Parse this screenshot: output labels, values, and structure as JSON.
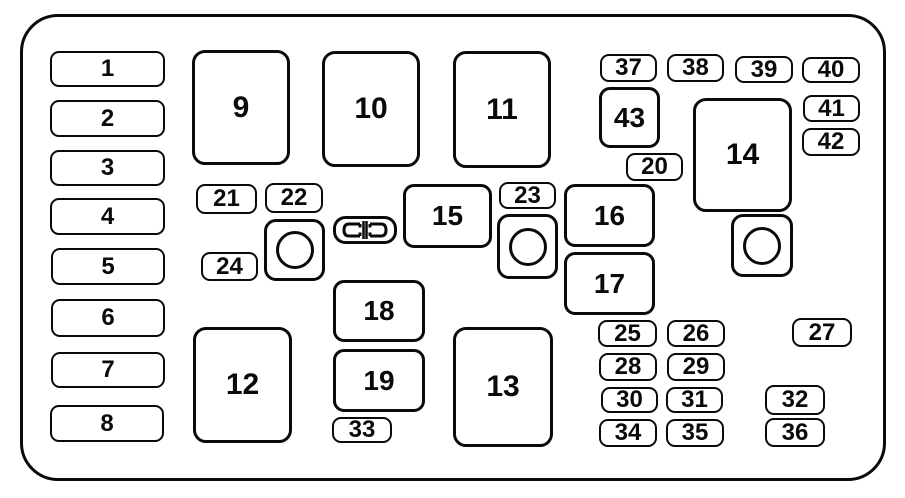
{
  "diagram": {
    "kind": "fuse-box-diagram",
    "background_color": "#ffffff",
    "line_color": "#0a0a0a",
    "canvas": {
      "width": 905,
      "height": 498
    },
    "outer_border": {
      "x": 20,
      "y": 14,
      "w": 866,
      "h": 467,
      "radius": 38
    },
    "elements": [
      {
        "label": "1",
        "type": "fuse",
        "x": 50,
        "y": 51,
        "w": 115,
        "h": 36
      },
      {
        "label": "2",
        "type": "fuse",
        "x": 50,
        "y": 100,
        "w": 115,
        "h": 37
      },
      {
        "label": "3",
        "type": "fuse",
        "x": 50,
        "y": 150,
        "w": 115,
        "h": 36
      },
      {
        "label": "4",
        "type": "fuse",
        "x": 50,
        "y": 198,
        "w": 115,
        "h": 37
      },
      {
        "label": "5",
        "type": "fuse",
        "x": 51,
        "y": 248,
        "w": 114,
        "h": 37
      },
      {
        "label": "6",
        "type": "fuse",
        "x": 51,
        "y": 299,
        "w": 114,
        "h": 38
      },
      {
        "label": "7",
        "type": "fuse",
        "x": 51,
        "y": 352,
        "w": 114,
        "h": 36
      },
      {
        "label": "8",
        "type": "fuse",
        "x": 50,
        "y": 405,
        "w": 114,
        "h": 37
      },
      {
        "label": "9",
        "type": "box",
        "x": 192,
        "y": 50,
        "w": 98,
        "h": 115
      },
      {
        "label": "10",
        "type": "box",
        "x": 322,
        "y": 51,
        "w": 98,
        "h": 116
      },
      {
        "label": "11",
        "type": "box",
        "x": 453,
        "y": 51,
        "w": 98,
        "h": 117
      },
      {
        "label": "12",
        "type": "box",
        "x": 193,
        "y": 327,
        "w": 99,
        "h": 116
      },
      {
        "label": "13",
        "type": "box",
        "x": 453,
        "y": 327,
        "w": 100,
        "h": 120
      },
      {
        "label": "14",
        "type": "box",
        "x": 693,
        "y": 98,
        "w": 99,
        "h": 114
      },
      {
        "label": "15",
        "type": "mid",
        "x": 403,
        "y": 184,
        "w": 89,
        "h": 64
      },
      {
        "label": "16",
        "type": "mid",
        "x": 564,
        "y": 184,
        "w": 91,
        "h": 63
      },
      {
        "label": "17",
        "type": "mid",
        "x": 564,
        "y": 252,
        "w": 91,
        "h": 63
      },
      {
        "label": "18",
        "type": "mid",
        "x": 333,
        "y": 280,
        "w": 92,
        "h": 62
      },
      {
        "label": "19",
        "type": "mid",
        "x": 333,
        "y": 349,
        "w": 92,
        "h": 63
      },
      {
        "label": "43",
        "type": "mid",
        "x": 599,
        "y": 87,
        "w": 61,
        "h": 61
      },
      {
        "label": "20",
        "type": "fuse",
        "x": 626,
        "y": 153,
        "w": 57,
        "h": 28
      },
      {
        "label": "21",
        "type": "fuse",
        "x": 196,
        "y": 184,
        "w": 61,
        "h": 30
      },
      {
        "label": "22",
        "type": "fuse",
        "x": 265,
        "y": 183,
        "w": 58,
        "h": 30
      },
      {
        "label": "23",
        "type": "fuse",
        "x": 499,
        "y": 182,
        "w": 57,
        "h": 27
      },
      {
        "label": "24",
        "type": "fuse",
        "x": 201,
        "y": 252,
        "w": 57,
        "h": 29
      },
      {
        "label": "25",
        "type": "fuse",
        "x": 598,
        "y": 320,
        "w": 59,
        "h": 27
      },
      {
        "label": "26",
        "type": "fuse",
        "x": 667,
        "y": 320,
        "w": 58,
        "h": 27
      },
      {
        "label": "27",
        "type": "fuse",
        "x": 792,
        "y": 318,
        "w": 60,
        "h": 29
      },
      {
        "label": "28",
        "type": "fuse",
        "x": 599,
        "y": 353,
        "w": 58,
        "h": 28
      },
      {
        "label": "29",
        "type": "fuse",
        "x": 667,
        "y": 353,
        "w": 58,
        "h": 28
      },
      {
        "label": "30",
        "type": "fuse",
        "x": 601,
        "y": 387,
        "w": 57,
        "h": 26
      },
      {
        "label": "31",
        "type": "fuse",
        "x": 666,
        "y": 387,
        "w": 57,
        "h": 26
      },
      {
        "label": "32",
        "type": "fuse",
        "x": 765,
        "y": 385,
        "w": 60,
        "h": 30
      },
      {
        "label": "33",
        "type": "fuse",
        "x": 332,
        "y": 417,
        "w": 60,
        "h": 26
      },
      {
        "label": "34",
        "type": "fuse",
        "x": 599,
        "y": 419,
        "w": 58,
        "h": 28
      },
      {
        "label": "35",
        "type": "fuse",
        "x": 666,
        "y": 419,
        "w": 58,
        "h": 28
      },
      {
        "label": "36",
        "type": "fuse",
        "x": 765,
        "y": 418,
        "w": 60,
        "h": 29
      },
      {
        "label": "37",
        "type": "fuse",
        "x": 600,
        "y": 54,
        "w": 57,
        "h": 28
      },
      {
        "label": "38",
        "type": "fuse",
        "x": 667,
        "y": 54,
        "w": 57,
        "h": 28
      },
      {
        "label": "39",
        "type": "fuse",
        "x": 735,
        "y": 56,
        "w": 58,
        "h": 27
      },
      {
        "label": "40",
        "type": "fuse",
        "x": 802,
        "y": 57,
        "w": 58,
        "h": 26
      },
      {
        "label": "41",
        "type": "fuse",
        "x": 803,
        "y": 95,
        "w": 57,
        "h": 27
      },
      {
        "label": "42",
        "type": "fuse",
        "x": 802,
        "y": 128,
        "w": 58,
        "h": 28
      },
      {
        "name": "relay-circle-box-left",
        "type": "circle",
        "x": 264,
        "y": 219,
        "w": 61,
        "h": 62
      },
      {
        "name": "relay-circle-box-center",
        "type": "circle",
        "x": 497,
        "y": 214,
        "w": 61,
        "h": 65
      },
      {
        "name": "relay-circle-box-right",
        "type": "circle",
        "x": 731,
        "y": 214,
        "w": 62,
        "h": 63
      },
      {
        "name": "fuse-puller-icon",
        "type": "connector",
        "x": 333,
        "y": 216,
        "w": 64,
        "h": 28
      }
    ]
  }
}
